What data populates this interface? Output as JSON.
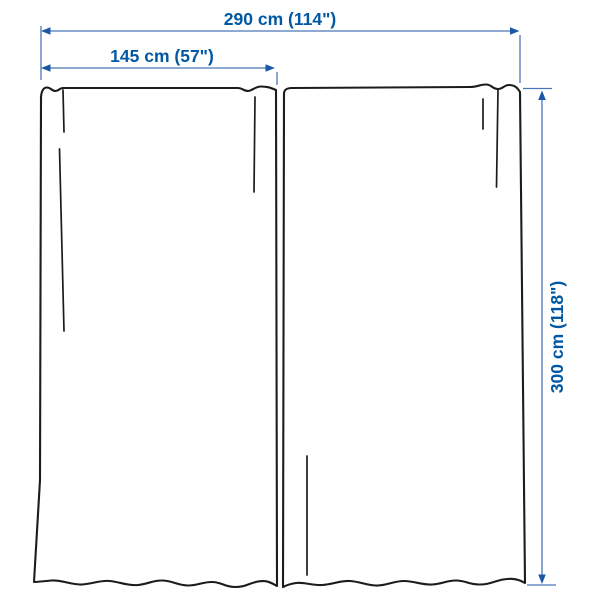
{
  "diagram": {
    "labels": {
      "total_width": "290 cm (114\")",
      "panel_width": "145 cm (57\")",
      "height": "300 cm (118\")"
    },
    "measurements": {
      "total_width_cm": 290,
      "total_width_in": 114,
      "panel_width_cm": 145,
      "panel_width_in": 57,
      "height_cm": 300,
      "height_in": 118
    },
    "panel_count": 2,
    "colors": {
      "dimension_text_blue": "#0058A3",
      "dimension_line_blue": "#4a76b8",
      "arrowhead_blue": "#1b57a6",
      "outline_dark": "#1c1c1c",
      "background": "#ffffff"
    }
  }
}
